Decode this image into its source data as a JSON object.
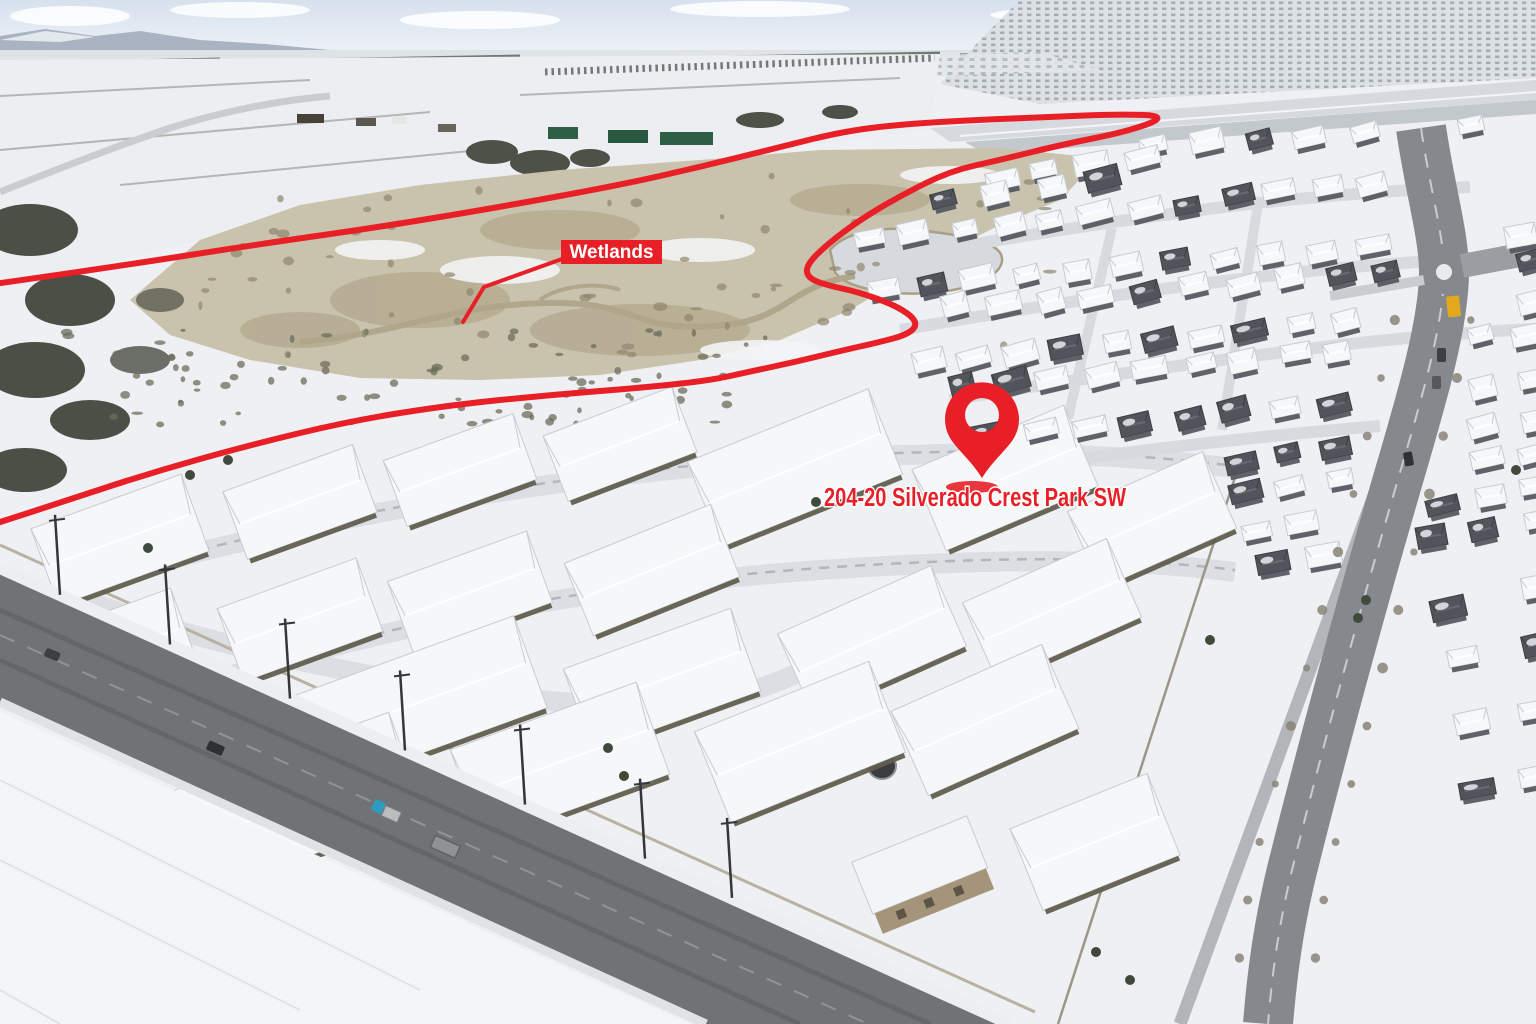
{
  "annotations": {
    "accent_color": "#e81f27",
    "wetlands_label": {
      "text": "Wetlands",
      "box": [
        561,
        240,
        101,
        24
      ],
      "text_color": "#ffffff",
      "font_size": 19
    },
    "pointer_line": {
      "points": [
        [
          562,
          259
        ],
        [
          484,
          287
        ],
        [
          463,
          322
        ]
      ],
      "width": 4
    },
    "boundary_line": {
      "width": 6,
      "points": [
        [
          -6,
          284
        ],
        [
          120,
          266
        ],
        [
          260,
          244
        ],
        [
          380,
          227
        ],
        [
          500,
          207
        ],
        [
          620,
          185
        ],
        [
          700,
          167
        ],
        [
          780,
          147
        ],
        [
          845,
          131
        ],
        [
          905,
          124
        ],
        [
          975,
          120
        ],
        [
          1050,
          117
        ],
        [
          1120,
          114
        ],
        [
          1168,
          116
        ],
        [
          1130,
          131
        ],
        [
          1060,
          145
        ],
        [
          1000,
          160
        ],
        [
          950,
          171
        ],
        [
          900,
          196
        ],
        [
          858,
          221
        ],
        [
          824,
          247
        ],
        [
          806,
          266
        ],
        [
          808,
          278
        ],
        [
          826,
          285
        ],
        [
          858,
          292
        ],
        [
          892,
          304
        ],
        [
          912,
          316
        ],
        [
          917,
          326
        ],
        [
          906,
          335
        ],
        [
          880,
          342
        ],
        [
          840,
          351
        ],
        [
          795,
          362
        ],
        [
          748,
          372
        ],
        [
          712,
          380
        ],
        [
          650,
          387
        ],
        [
          550,
          395
        ],
        [
          450,
          405
        ],
        [
          350,
          421
        ],
        [
          250,
          445
        ],
        [
          150,
          473
        ],
        [
          50,
          506
        ],
        [
          -6,
          524
        ]
      ]
    },
    "location_pin": {
      "cx": 982,
      "cy": 420,
      "r": 37,
      "hole_cx": 982,
      "hole_cy": 415,
      "hole_r": 17,
      "tip_y": 478,
      "shadow": {
        "cx": 972,
        "cy": 487,
        "rx": 26,
        "ry": 6
      }
    },
    "address_label": {
      "text": "204-20 Silverado Crest Park SW",
      "x": 975,
      "y": 506,
      "text_length": 302,
      "font_size": 25.5,
      "text_color": "#e81f27",
      "outline_color": "#ffffff"
    }
  }
}
